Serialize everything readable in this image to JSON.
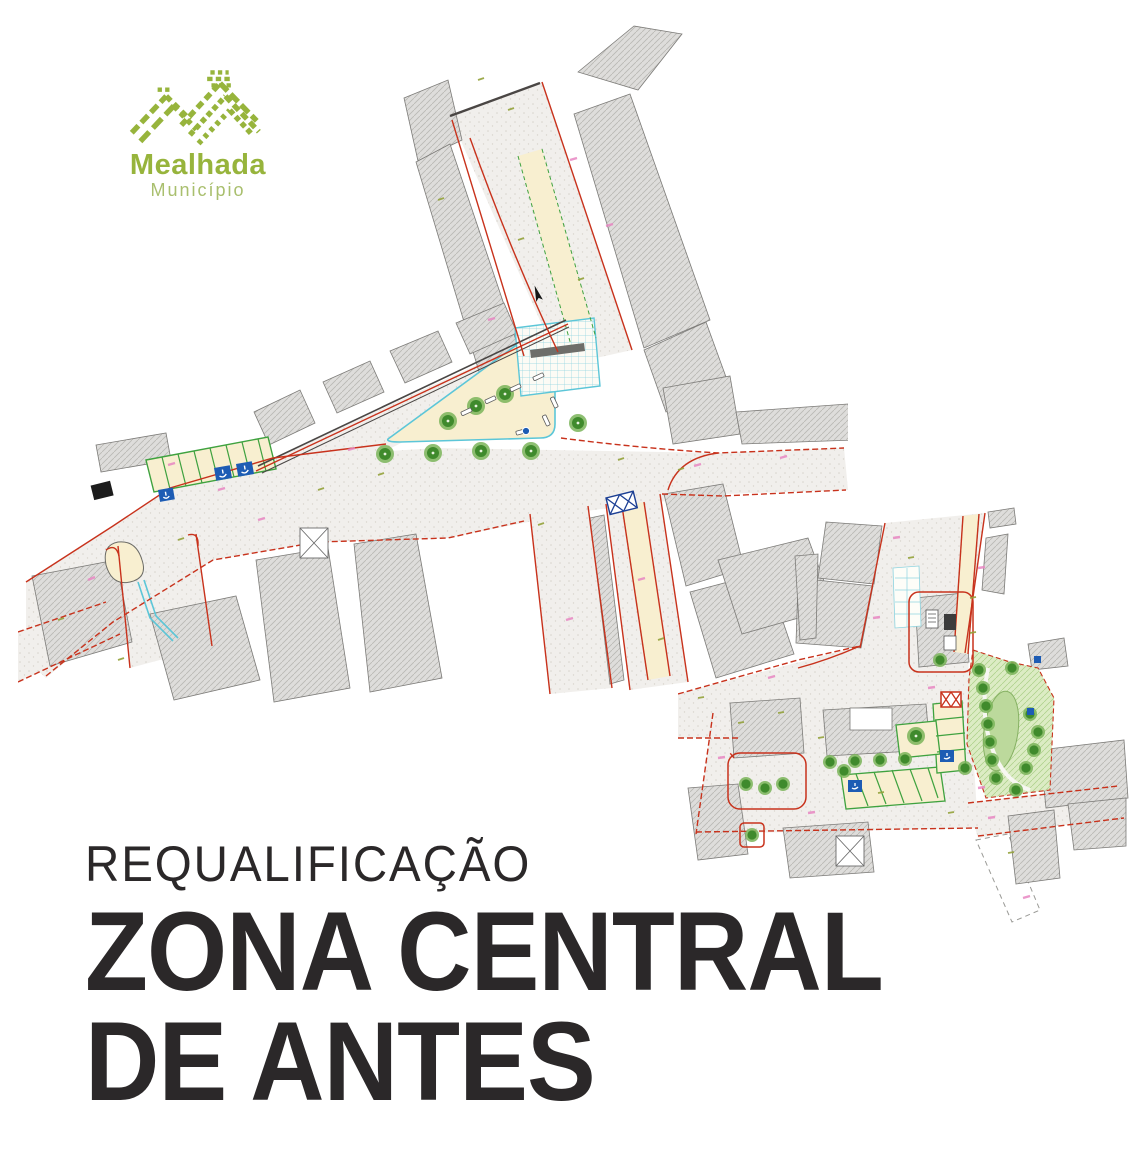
{
  "logo": {
    "title": "Mealhada",
    "subtitle": "Município",
    "brand_green": "#97b43c",
    "subtitle_green": "#a9bf6e"
  },
  "heading": {
    "kicker": "REQUALIFICAÇÃO",
    "title_line1": "ZONA CENTRAL",
    "title_line2": "DE ANTES",
    "text_color": "#2b2829"
  },
  "plans": {
    "palette": {
      "building_fill": "#dedddb",
      "building_hatch": "#b9b8b4",
      "road_fill": "#f1efec",
      "road_edge_red": "#c8321c",
      "pavement_beige": "#f8efd0",
      "parking_green": "#3fa23f",
      "plaza_cyan": "#5cc6d8",
      "tree_green": "#3f8a2c",
      "park_fill": "#dcecc4",
      "accessible_blue": "#1d5cb4",
      "annotation_pink": "#e886c2",
      "annotation_olive": "#93a23b"
    }
  }
}
